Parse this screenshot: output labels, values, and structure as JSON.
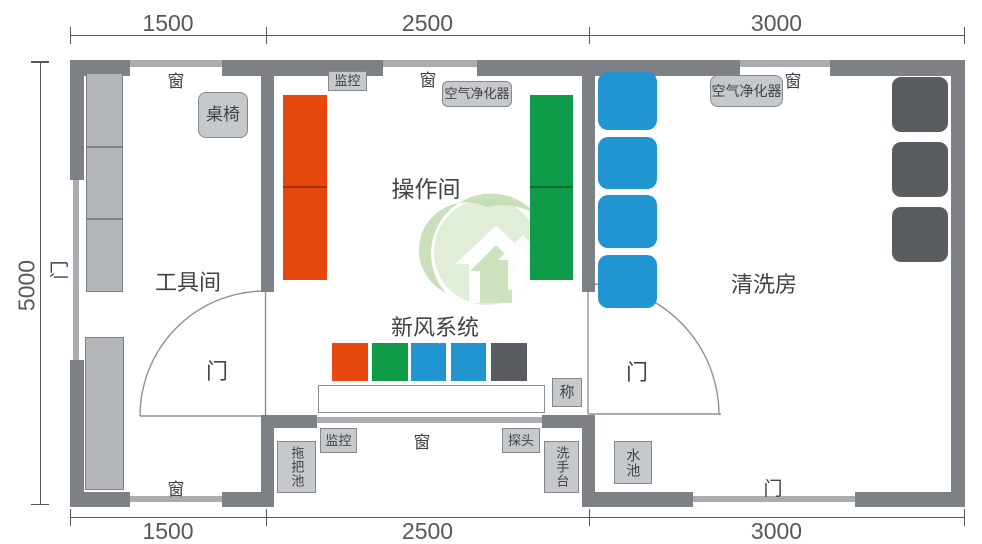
{
  "dimensions": {
    "top": [
      "1500",
      "2500",
      "3000"
    ],
    "bottom": [
      "1500",
      "2500",
      "3000"
    ],
    "left": "5000"
  },
  "rooms": {
    "tool": "工具间",
    "operation": "操作间",
    "cleaning": "清洗房"
  },
  "labels": {
    "window": "窗",
    "door": "门",
    "freshAir": "新风系统",
    "monitor": "监控",
    "airPurifier": "空气净化器",
    "deskChair": "桌椅",
    "scale": "称",
    "probe": "探头",
    "mopSink": "拖把池",
    "washBasin": "洗手台",
    "waterSink": "水池"
  },
  "colors": {
    "wall": "#7d8185",
    "opening": "#a9adb1",
    "furniture": "#b4b7ba",
    "furniture-border": "#7e8184",
    "labelbox": "#c6c9cb",
    "labelbox-border": "#85888b",
    "orange": "#e5470d",
    "green": "#0f9b47",
    "blue": "#2095d2",
    "darkgray": "#595d62",
    "text": "#3f4347",
    "dim": "#55595c",
    "wm-light": "#cde1bd",
    "wm-mid": "#b2d29a"
  }
}
